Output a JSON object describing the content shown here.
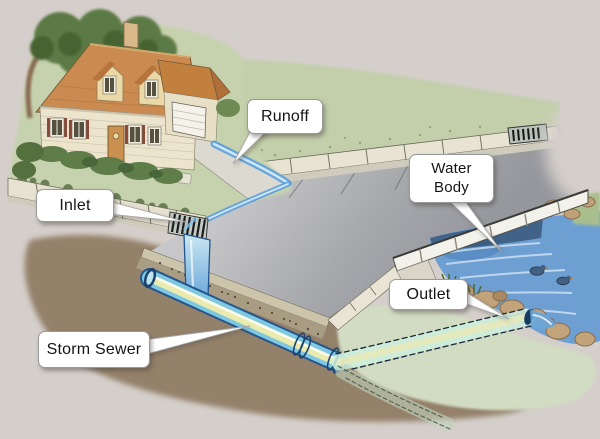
{
  "page": {
    "background_color": "#d4cfca"
  },
  "diagram": {
    "type": "storm-sewer-cutaway-illustration",
    "callouts": [
      {
        "id": "runoff",
        "text": "Runoff"
      },
      {
        "id": "inlet",
        "text": "Inlet"
      },
      {
        "id": "water_body",
        "text": "Water Body",
        "line1": "Water",
        "line2": "Body"
      },
      {
        "id": "outlet",
        "text": "Outlet"
      },
      {
        "id": "storm_sewer",
        "text": "Storm Sewer"
      }
    ],
    "callout_style": {
      "bg": "#ffffff",
      "border": "#9a9a9a",
      "text_color": "#141414"
    },
    "colors": {
      "grass": "#c5d1ac",
      "pale_grass": "#d2dcc2",
      "soil": "#94816b",
      "street": "#aeaeb2",
      "water": "#6d9fd2",
      "pipe": "#7fc8e2",
      "pipe_highlight": "#f0edaa",
      "pipe_outline": "#24568e",
      "roof": "#cb8a50",
      "house_wall": "#ece4cc",
      "curb": "#e6e1d0"
    },
    "scene_elements": [
      "house",
      "tree",
      "lawn",
      "driveway",
      "street",
      "sidewalk",
      "inlet-grate",
      "far-storm-grate",
      "storm-sewer-pipe",
      "outlet-pipe",
      "stream",
      "bridge",
      "rocks",
      "ducks",
      "soil-cutaway"
    ]
  }
}
